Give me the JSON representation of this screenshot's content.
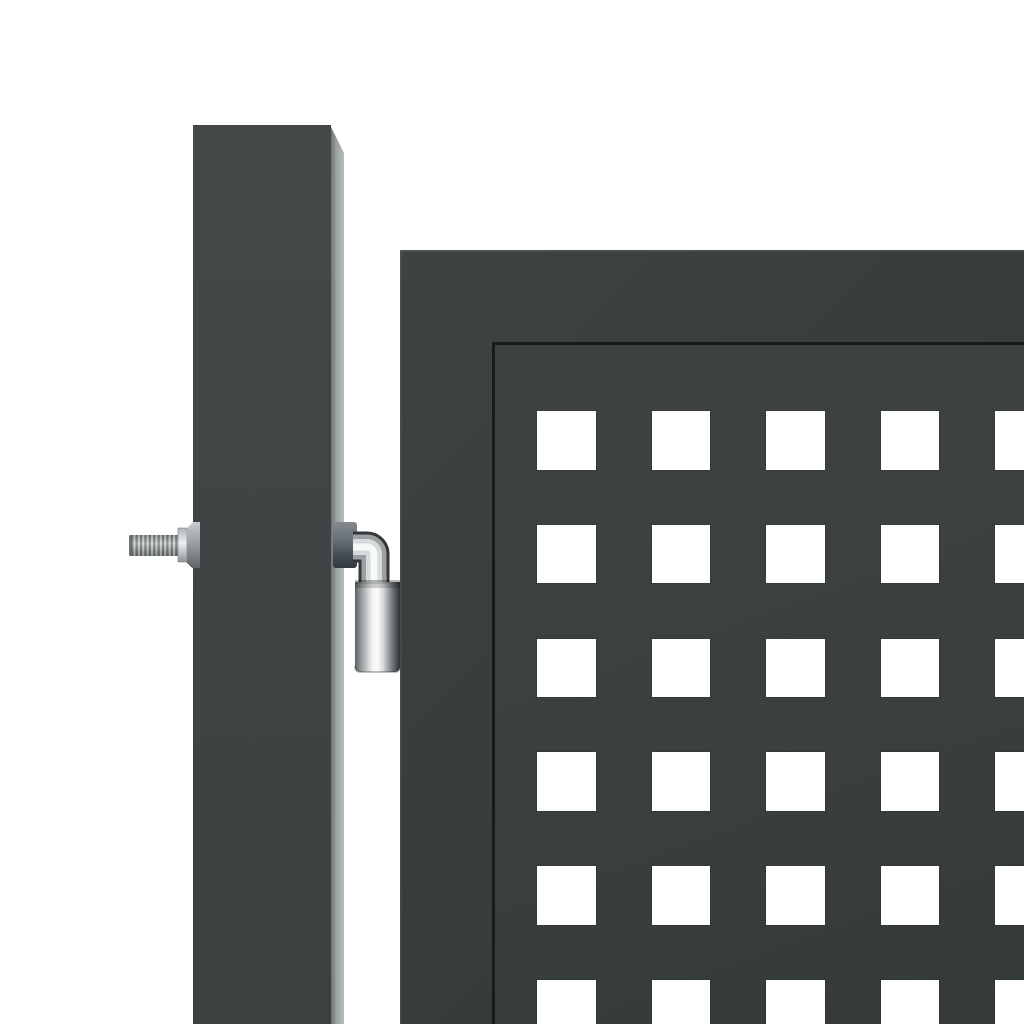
{
  "meta": {
    "description": "Product photo: anthracite grey metal garden gate with square lattice in-fill, square hinge post with threaded bolt and chrome 90-degree hinge pin, on plain white background",
    "visible_text": []
  },
  "colors": {
    "bg": "#ffffff",
    "post-front": "#3f4544",
    "post-top": "#434948",
    "post-bottom": "#3b4140",
    "post-side-inner": "#6f7576",
    "post-side-mid": "#9da3a2",
    "post-side-outer": "#b7bcbb",
    "gate-frame": "#383e3d",
    "gate-frame-light": "#3d4342",
    "gate-frame-dark": "#333938",
    "inner-line": "#171b1a",
    "panel": "#3a403f",
    "panel-light": "#3d4342",
    "panel-dark": "#343a39",
    "square": "#ffffff",
    "chrome-dark": "#33383a",
    "chrome-mid": "#9ba0a1",
    "chrome-light": "#d7dadb",
    "chrome-bright": "#f7f8f8"
  },
  "post": {
    "left": 193,
    "top": 125,
    "front_width": 138,
    "side_width": 13,
    "height": 899
  },
  "gate": {
    "left": 400,
    "top": 250,
    "width": 624,
    "height": 774,
    "frame_band": 92,
    "inner_line_thickness": 3,
    "lattice": {
      "rows": 6,
      "cols": 5,
      "square_size": 58.5,
      "first_col_offset": 42,
      "first_row_offset": 66,
      "x_pitch": 114.6,
      "y_pitch": 113.8
    }
  },
  "hardware": {
    "bolt": {
      "rod_x": 129,
      "rod_y": 535,
      "rod_w": 53,
      "rod_h": 21,
      "nut_y": 522,
      "nut_h": 46
    },
    "hinge": {
      "sleeve_x": 355,
      "sleeve_y": 582,
      "sleeve_w": 45,
      "sleeve_h": 90
    }
  }
}
